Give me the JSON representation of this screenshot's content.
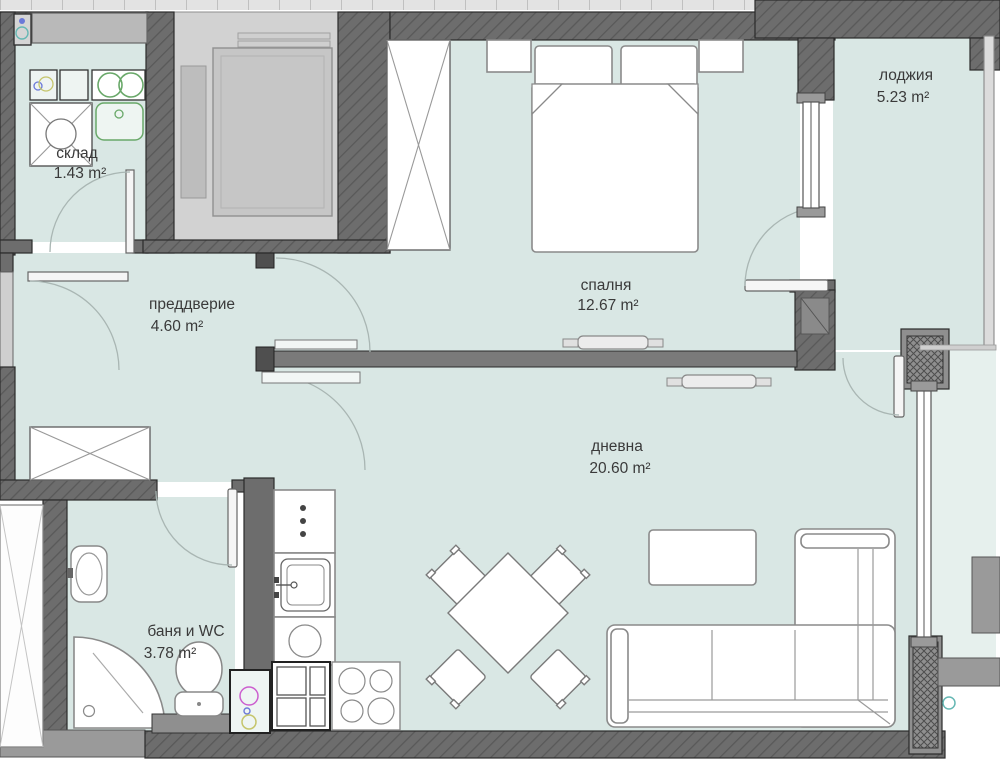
{
  "title": "Апартамент — разпределение",
  "rooms": {
    "sklad": {
      "name": "склад",
      "area": "1.43 m²"
    },
    "vestibule": {
      "name": "преддверие",
      "area": "4.60 m²"
    },
    "bedroom": {
      "name": "спалня",
      "area": "12.67 m²"
    },
    "loggia": {
      "name": "лоджия",
      "area": "5.23 m²"
    },
    "living": {
      "name": "дневна",
      "area": "20.60 m²"
    },
    "bath": {
      "name": "баня и WC",
      "area": "3.78 m²"
    }
  },
  "colors": {
    "floor": "#d9e7e4",
    "floor_light": "#e6f0ed",
    "wall": "#6d6d6d",
    "wall_light": "#9a9a9a",
    "accent_green": "#69a869",
    "accent_magenta": "#cc5fcf",
    "accent_yellow": "#c5c56b",
    "accent_blue": "#6b79d8",
    "accent_teal": "#66b8b4"
  }
}
